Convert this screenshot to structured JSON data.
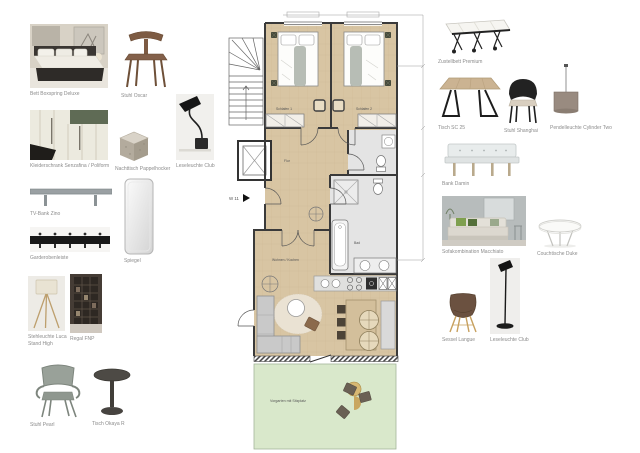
{
  "board": {
    "left_items": [
      {
        "label": "Bett Boxspring Deluxe"
      },
      {
        "label": "Stuhl Oscar"
      },
      {
        "label": "Kleiderschrank Senzafina / Poliform"
      },
      {
        "label": "Nachttisch Pappelhocker"
      },
      {
        "label": "Leseleuchte Club"
      },
      {
        "label": "TV-Bank Zino"
      },
      {
        "label": "Garderobenleiste"
      },
      {
        "label": "Spiegel"
      },
      {
        "label": "Stehleuchte Luca Stand High"
      },
      {
        "label": "Regal FNP"
      },
      {
        "label": "Stuhl Pearl"
      },
      {
        "label": "Tisch Okaya R"
      }
    ],
    "right_items": [
      {
        "label": "Zustellbett Premium"
      },
      {
        "label": "Tisch SC 25"
      },
      {
        "label": "Stuhl Shanghai"
      },
      {
        "label": "Pendelleuchte Cylinder Two"
      },
      {
        "label": "Bank Damin"
      },
      {
        "label": "Sofakombination Macchiato"
      },
      {
        "label": "Couchtische Duke"
      },
      {
        "label": "Sessel Langue"
      },
      {
        "label": "Leseleuchte Club"
      }
    ]
  },
  "floorplan": {
    "entrance": "W 11",
    "bedroom1": "Schlafen 1",
    "bedroom2": "Schlafen 2",
    "hall": "Flur",
    "bath": "Bad",
    "living": "Wohnen / Kochen",
    "terrace": "Vorgarten mit Sitzplatz"
  },
  "colors": {
    "floor": "#d8c5a3",
    "bath": "#e4e4e4",
    "terrace": "#d9e8cb",
    "wall": "#3a3a3a"
  }
}
